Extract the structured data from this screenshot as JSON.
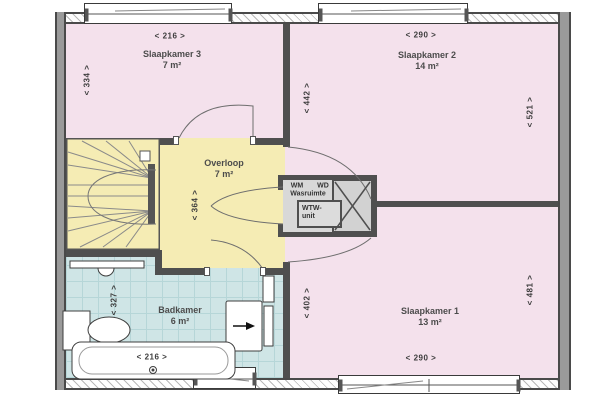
{
  "rooms": {
    "slaapkamer3": {
      "name": "Slaapkamer 3",
      "area": "7 m²",
      "dim_top": "< 216 >",
      "dim_left": "< 334 >"
    },
    "slaapkamer2": {
      "name": "Slaapkamer 2",
      "area": "14 m²",
      "dim_top": "< 290 >",
      "dim_left": "< 442 >",
      "dim_right": "< 521 >"
    },
    "slaapkamer1": {
      "name": "Slaapkamer 1",
      "area": "13 m²",
      "dim_left": "< 402 >",
      "dim_right": "< 481 >",
      "dim_bottom": "< 290 >"
    },
    "overloop": {
      "name": "Overloop",
      "area": "7 m²",
      "dim_height": "< 364 >"
    },
    "badkamer": {
      "name": "Badkamer",
      "area": "6 m²",
      "dim_height": "< 327 >",
      "dim_width": "< 216 >"
    },
    "wasruimte": {
      "name": "Wasruimte",
      "appliance_left": "WM",
      "appliance_right": "WD",
      "unit_line1": "WTW-",
      "unit_line2": "unit"
    }
  },
  "colors": {
    "bedroom": "#f4e1ec",
    "landing": "#f5ecb4",
    "bathroom": "#cfe5e6",
    "wall": "#4f4f4f",
    "white": "#ffffff"
  }
}
